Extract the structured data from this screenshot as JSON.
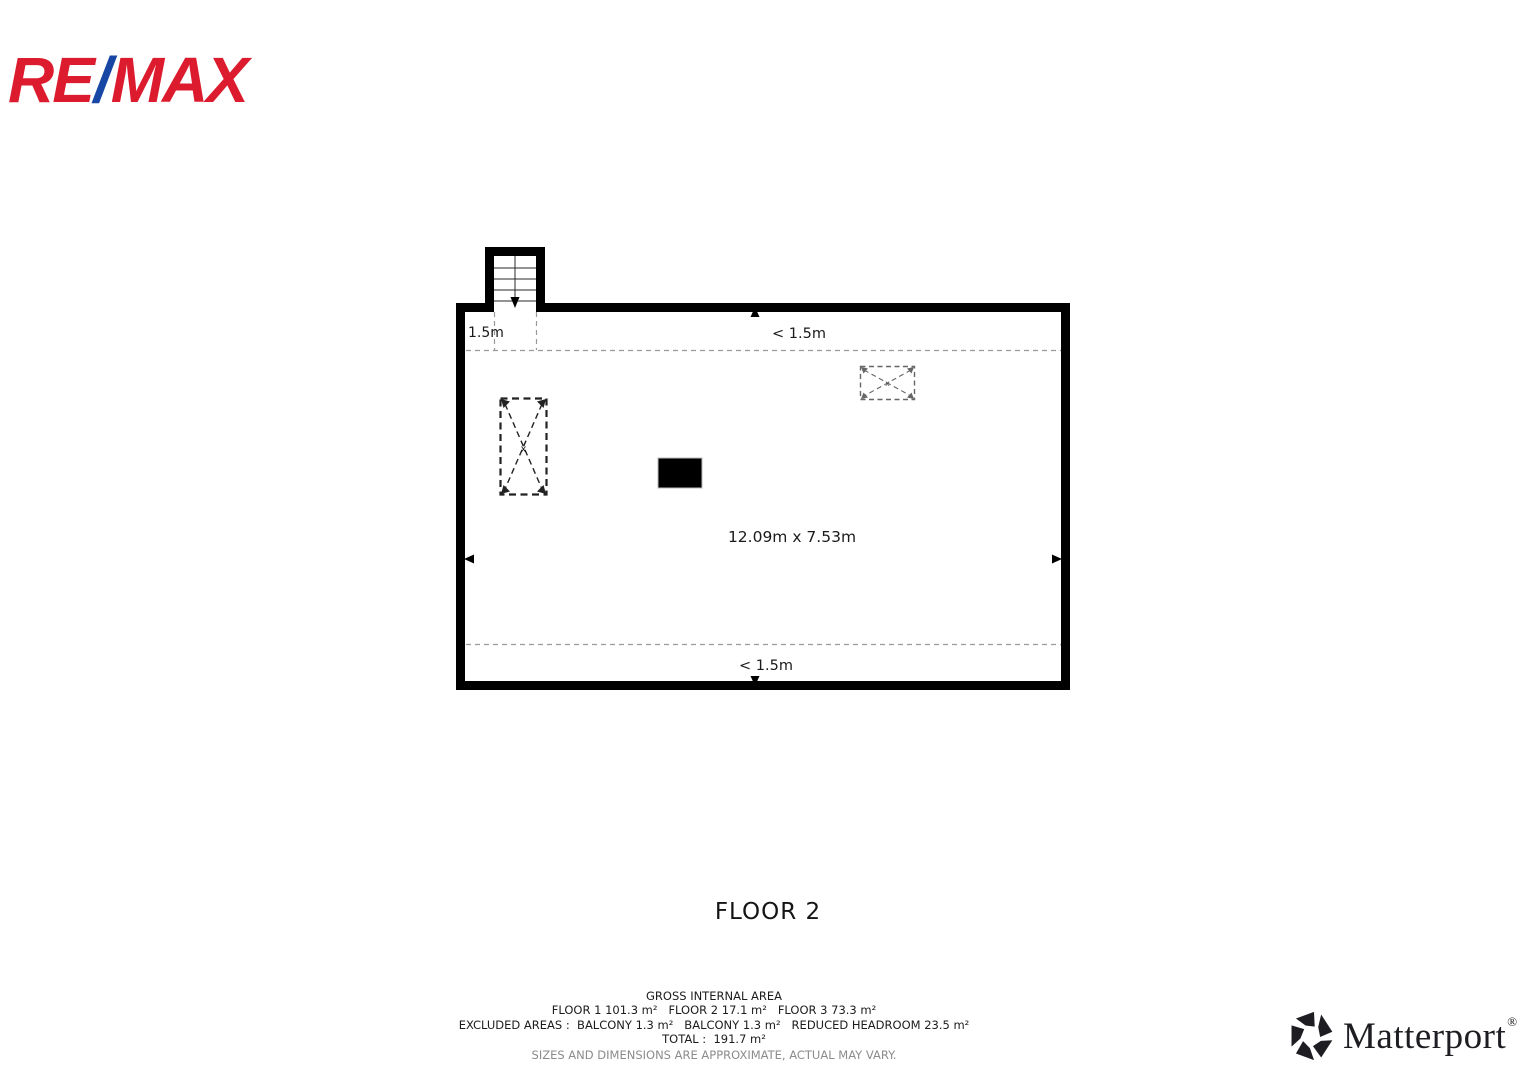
{
  "branding": {
    "remax": {
      "part1": "RE",
      "slash": "/",
      "part2": "MAX",
      "red": "#dc1c2e",
      "blue": "#1746a5"
    },
    "matterport": {
      "name": "Matterport",
      "registered": "®",
      "color": "#1d1d22"
    }
  },
  "floor_plan": {
    "title": "FLOOR 2",
    "labels": {
      "stair_headroom": "1.5m",
      "top_headroom": "< 1.5m",
      "room_dimensions": "12.09m x 7.53m",
      "bottom_headroom": "< 1.5m",
      "x_marker_left": "x",
      "x_marker_right": "x"
    },
    "colors": {
      "walls": "#000000",
      "dashed_lines": "#999999",
      "crossed_box_left": "#222222",
      "crossed_box_right": "#666666"
    }
  },
  "floor_title": "FLOOR 2",
  "area_summary": {
    "heading": "GROSS INTERNAL AREA",
    "floors_line": "FLOOR 1 101.3 m²   FLOOR 2 17.1 m²   FLOOR 3 73.3 m²",
    "excluded_line": "EXCLUDED AREAS :  BALCONY 1.3 m²   BALCONY 1.3 m²   REDUCED HEADROOM 23.5 m²",
    "total_line": "TOTAL :  191.7 m²",
    "disclaimer": "SIZES AND DIMENSIONS ARE APPROXIMATE, ACTUAL MAY VARY."
  }
}
